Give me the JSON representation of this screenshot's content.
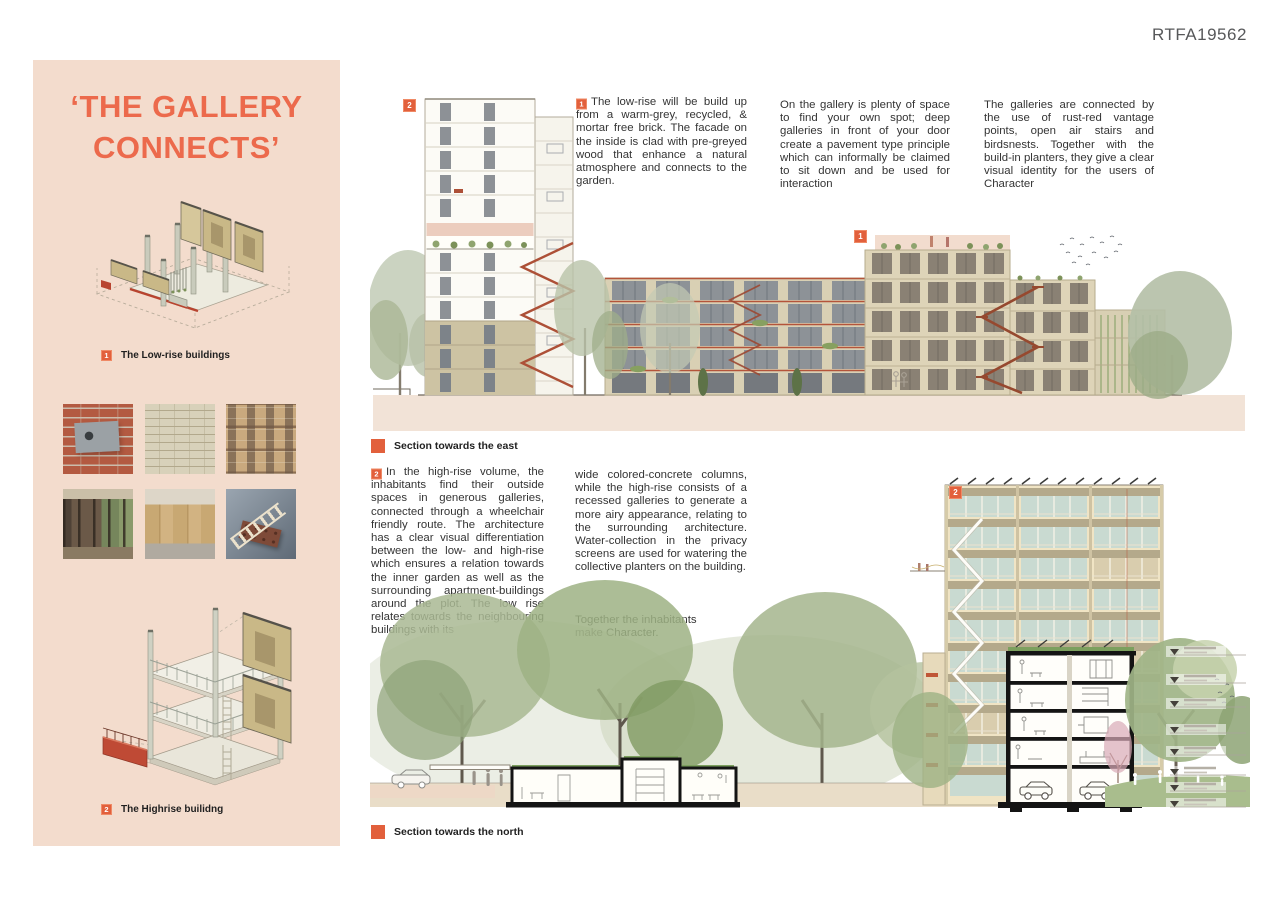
{
  "board_id": "RTFA19562",
  "colors": {
    "accent": "#e2603c",
    "sidebar_bg": "#f3dccd",
    "title": "#ec6a4c",
    "rust": "#b4543a",
    "ground_band": "#f2e3d7"
  },
  "sidebar": {
    "title_line1": "‘THE GALLERY",
    "title_line2": "CONNECTS’",
    "legend": [
      {
        "num": "1",
        "label": "The Low-rise buildings"
      },
      {
        "num": "2",
        "label": "The Highrise builidng"
      }
    ]
  },
  "intro": {
    "p1_num": "1",
    "p1": "The low-rise will be build up from a warm-grey, recycled, & mortar free brick. The facade on the inside is clad with pre-greyed wood that enhance a natural atmosphere and connects to the garden.",
    "p2": "On the gallery is plenty of space to find your own spot; deep galleries in front of your door create a pavement type principle which can informally be claimed to sit down and be used for interaction",
    "p3": "The galleries are connected by the use of rust-red vantage points, open air stairs and birdsnests. Together with the build-in planters, they give a clear visual identity for the users of Character"
  },
  "east_section": {
    "label": "Section towards the east",
    "marker_tall": "2",
    "marker_low": "1"
  },
  "highrise": {
    "num": "2",
    "col1": "In the high-rise volume, the inhabitants find their outside spaces in generous galleries, connected through a wheelchair friendly route. The architecture has a clear visual differentiation between the low- and high-rise which ensures a relation towards the inner garden as well as the surrounding apartment-buildings around the plot. The low rise relates towards the neighbouring buildings with its",
    "col2": "wide colored-concrete columns, while the high-rise consists of a recessed galleries to generate a more airy appearance, relating to the surrounding architecture. Water-collection in the privacy screens are used for watering the collective planters on the building.",
    "closing": "Together the inhabitants\nmake Character."
  },
  "north_section": {
    "label": "Section towards the north",
    "marker": "2"
  }
}
